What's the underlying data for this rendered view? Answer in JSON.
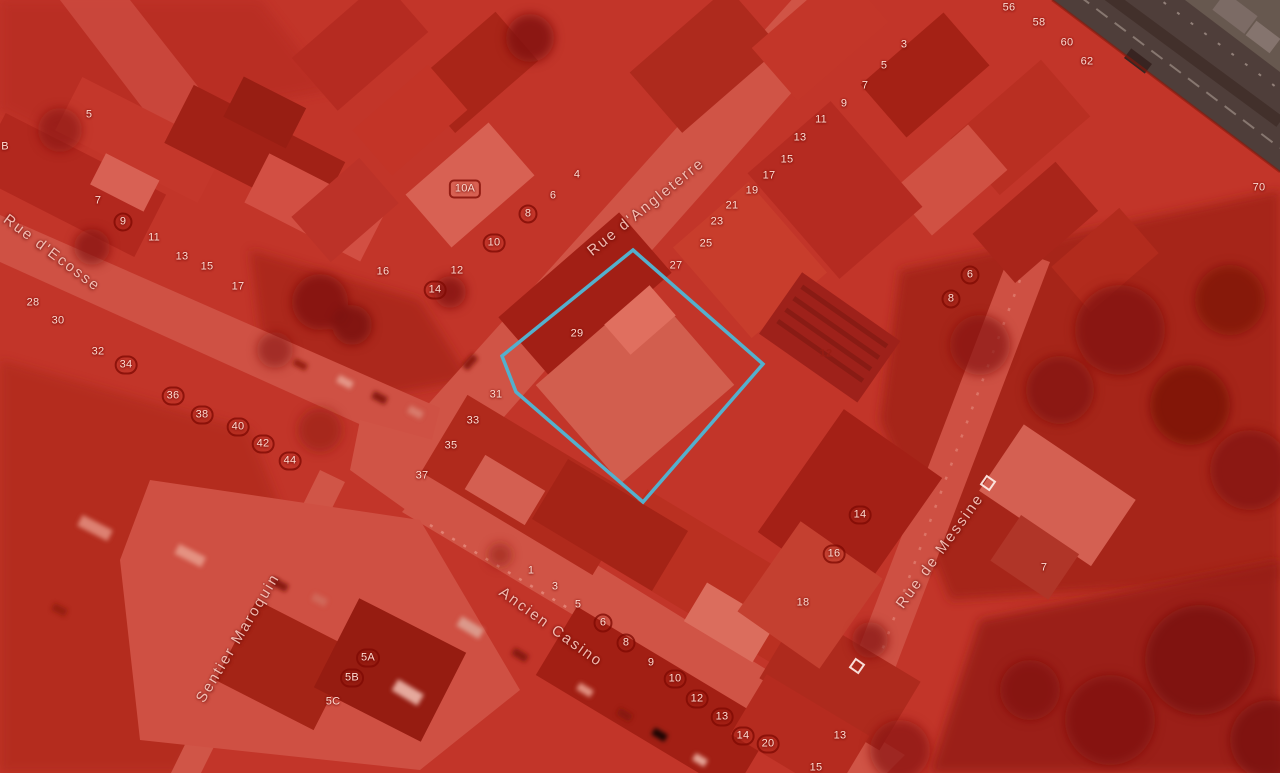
{
  "map": {
    "type": "aerial-imagery-with-cadastre-overlay",
    "overlay_color": "#d0281c",
    "highlight_color": "#3fc6ea",
    "badge_ring_color": "#800a04",
    "streets": [
      {
        "name": "Rue d'Ecosse",
        "x": 52,
        "y": 253,
        "rotate": 37
      },
      {
        "name": "Rue d'Angleterre",
        "x": 646,
        "y": 207,
        "rotate": -39
      },
      {
        "name": "Sentier Maroquin",
        "x": 238,
        "y": 638,
        "rotate": -59
      },
      {
        "name": "Ancien Casino",
        "x": 551,
        "y": 627,
        "rotate": 36
      },
      {
        "name": "Rue de Messine",
        "x": 940,
        "y": 551,
        "rotate": -54
      }
    ],
    "highlight_parcel": {
      "label": "29",
      "points": [
        [
          633,
          250
        ],
        [
          763,
          364
        ],
        [
          643,
          502
        ],
        [
          516,
          392
        ],
        [
          502,
          356
        ]
      ]
    },
    "square_markers": [
      {
        "x": 988,
        "y": 483
      },
      {
        "x": 857,
        "y": 666
      }
    ],
    "parcel_labels": [
      {
        "t": "5",
        "x": 89,
        "y": 115
      },
      {
        "t": "B",
        "x": 5,
        "y": 147
      },
      {
        "t": "7",
        "x": 98,
        "y": 201
      },
      {
        "t": "9",
        "x": 123,
        "y": 222,
        "b": "c"
      },
      {
        "t": "11",
        "x": 154,
        "y": 238
      },
      {
        "t": "13",
        "x": 182,
        "y": 257
      },
      {
        "t": "15",
        "x": 207,
        "y": 267
      },
      {
        "t": "17",
        "x": 238,
        "y": 287
      },
      {
        "t": "28",
        "x": 33,
        "y": 303
      },
      {
        "t": "30",
        "x": 58,
        "y": 321
      },
      {
        "t": "32",
        "x": 98,
        "y": 352
      },
      {
        "t": "34",
        "x": 126,
        "y": 365,
        "b": "c"
      },
      {
        "t": "36",
        "x": 173,
        "y": 396,
        "b": "c"
      },
      {
        "t": "38",
        "x": 202,
        "y": 415,
        "b": "c"
      },
      {
        "t": "40",
        "x": 238,
        "y": 427,
        "b": "c"
      },
      {
        "t": "42",
        "x": 263,
        "y": 444,
        "b": "c"
      },
      {
        "t": "44",
        "x": 290,
        "y": 461,
        "b": "c"
      },
      {
        "t": "10A",
        "x": 465,
        "y": 189,
        "b": "r"
      },
      {
        "t": "4",
        "x": 577,
        "y": 175
      },
      {
        "t": "6",
        "x": 553,
        "y": 196
      },
      {
        "t": "8",
        "x": 528,
        "y": 214,
        "b": "c"
      },
      {
        "t": "10",
        "x": 494,
        "y": 243,
        "b": "c"
      },
      {
        "t": "16",
        "x": 383,
        "y": 272
      },
      {
        "t": "12",
        "x": 457,
        "y": 271
      },
      {
        "t": "14",
        "x": 435,
        "y": 290,
        "b": "c"
      },
      {
        "t": "19",
        "x": 752,
        "y": 191
      },
      {
        "t": "21",
        "x": 732,
        "y": 206
      },
      {
        "t": "23",
        "x": 717,
        "y": 222
      },
      {
        "t": "25",
        "x": 706,
        "y": 244
      },
      {
        "t": "27",
        "x": 676,
        "y": 266
      },
      {
        "t": "29",
        "x": 577,
        "y": 334
      },
      {
        "t": "31",
        "x": 496,
        "y": 395
      },
      {
        "t": "33",
        "x": 473,
        "y": 421
      },
      {
        "t": "35",
        "x": 451,
        "y": 446
      },
      {
        "t": "37",
        "x": 422,
        "y": 476
      },
      {
        "t": "3",
        "x": 904,
        "y": 45
      },
      {
        "t": "5",
        "x": 884,
        "y": 66
      },
      {
        "t": "7",
        "x": 865,
        "y": 86
      },
      {
        "t": "9",
        "x": 844,
        "y": 104
      },
      {
        "t": "11",
        "x": 821,
        "y": 120
      },
      {
        "t": "13",
        "x": 800,
        "y": 138
      },
      {
        "t": "15",
        "x": 787,
        "y": 160
      },
      {
        "t": "17",
        "x": 769,
        "y": 176
      },
      {
        "t": "56",
        "x": 1009,
        "y": 8
      },
      {
        "t": "58",
        "x": 1039,
        "y": 23
      },
      {
        "t": "60",
        "x": 1067,
        "y": 43
      },
      {
        "t": "62",
        "x": 1087,
        "y": 62
      },
      {
        "t": "70",
        "x": 1259,
        "y": 188
      },
      {
        "t": "6",
        "x": 970,
        "y": 275,
        "b": "c"
      },
      {
        "t": "8",
        "x": 951,
        "y": 299,
        "b": "c"
      },
      {
        "t": "12",
        "x": 826,
        "y": 354,
        "b": "d"
      },
      {
        "t": "14",
        "x": 860,
        "y": 515,
        "b": "c"
      },
      {
        "t": "16",
        "x": 834,
        "y": 554,
        "b": "c"
      },
      {
        "t": "18",
        "x": 803,
        "y": 603
      },
      {
        "t": "7",
        "x": 1044,
        "y": 568
      },
      {
        "t": "1",
        "x": 531,
        "y": 571
      },
      {
        "t": "3",
        "x": 555,
        "y": 587
      },
      {
        "t": "5",
        "x": 578,
        "y": 605
      },
      {
        "t": "6",
        "x": 603,
        "y": 623,
        "b": "c"
      },
      {
        "t": "8",
        "x": 626,
        "y": 643,
        "b": "c"
      },
      {
        "t": "9",
        "x": 651,
        "y": 663
      },
      {
        "t": "10",
        "x": 675,
        "y": 679,
        "b": "c"
      },
      {
        "t": "12",
        "x": 697,
        "y": 699,
        "b": "c"
      },
      {
        "t": "13",
        "x": 722,
        "y": 717,
        "b": "c"
      },
      {
        "t": "14",
        "x": 743,
        "y": 736,
        "b": "c"
      },
      {
        "t": "20",
        "x": 768,
        "y": 744,
        "b": "c"
      },
      {
        "t": "13",
        "x": 840,
        "y": 736
      },
      {
        "t": "15",
        "x": 816,
        "y": 768
      },
      {
        "t": "5A",
        "x": 368,
        "y": 658,
        "b": "c"
      },
      {
        "t": "5B",
        "x": 352,
        "y": 678,
        "b": "c"
      },
      {
        "t": "5C",
        "x": 333,
        "y": 702
      }
    ]
  }
}
